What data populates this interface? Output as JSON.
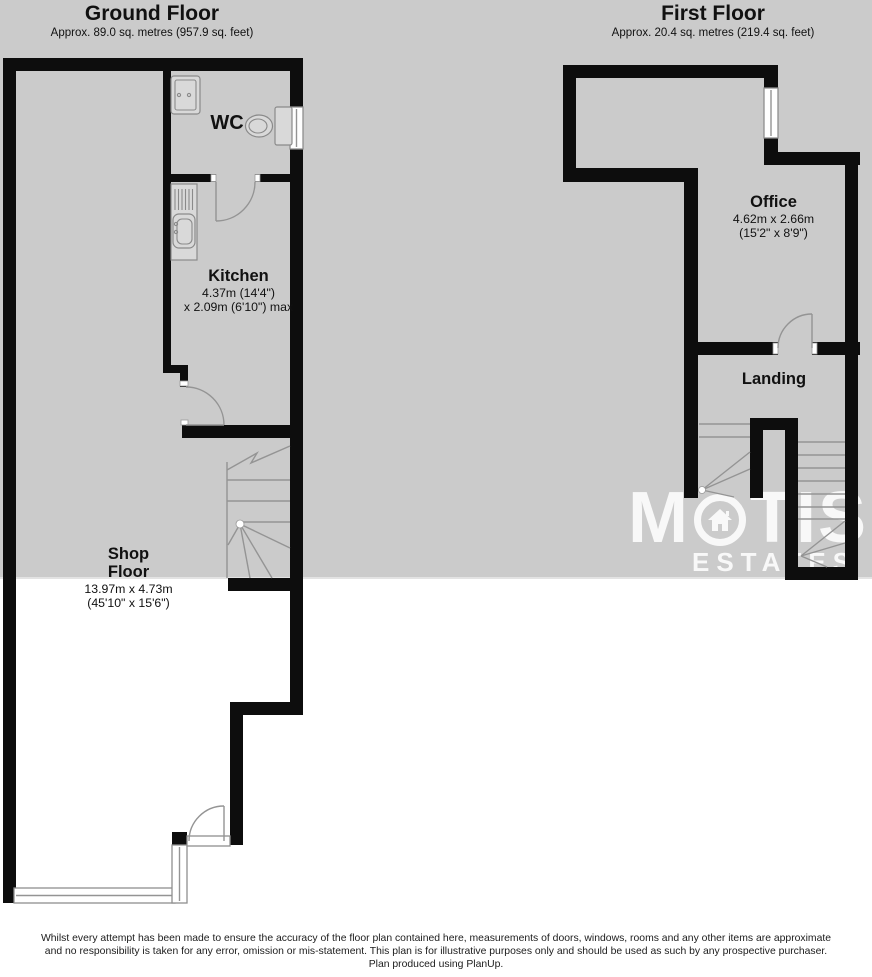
{
  "colors": {
    "background_band": "#cbcbcb",
    "wall": "#0d0d0d",
    "detail_line": "#949494",
    "watermark": "#ffffff"
  },
  "ground_floor": {
    "title": "Ground Floor",
    "subtitle": "Approx. 89.0 sq. metres (957.9 sq. feet)",
    "rooms": {
      "wc": {
        "name": "WC"
      },
      "kitchen": {
        "name": "Kitchen",
        "dim_line1": "4.37m (14'4\")",
        "dim_line2": "x 2.09m (6'10\") max"
      },
      "shop_floor": {
        "name_line1": "Shop",
        "name_line2": "Floor",
        "dim_line1": "13.97m x 4.73m",
        "dim_line2": "(45'10\" x 15'6\")"
      }
    }
  },
  "first_floor": {
    "title": "First Floor",
    "subtitle": "Approx. 20.4 sq. metres (219.4 sq. feet)",
    "rooms": {
      "office": {
        "name": "Office",
        "dim_line1": "4.62m x 2.66m",
        "dim_line2": "(15'2\" x 8'9\")"
      },
      "landing": {
        "name": "Landing"
      }
    }
  },
  "watermark": {
    "brand_prefix": "M",
    "brand_suffix": "TIS",
    "brand_subtitle": "ESTATES",
    "o_icon": "house-icon"
  },
  "disclaimer": {
    "line1": "Whilst every attempt has been made to ensure the accuracy of the floor plan contained here, measurements of doors, windows, rooms and any other items are approximate",
    "line2": "and no responsibility is taken for any error, omission or mis-statement. This plan is for illustrative purposes only and should be used as such by any prospective purchaser.",
    "line3": "Plan produced using PlanUp."
  }
}
